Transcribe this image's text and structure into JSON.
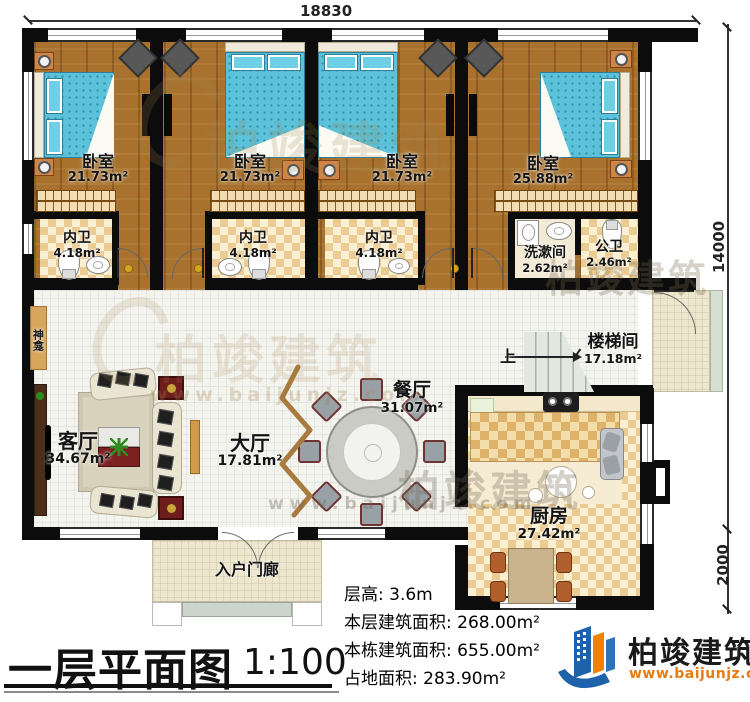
{
  "dimensions": {
    "width_top": "18830",
    "depth_main": "14000",
    "depth_porch": "2000"
  },
  "rooms": {
    "bedroom1": {
      "name": "卧室",
      "area": "21.73m²"
    },
    "bedroom2": {
      "name": "卧室",
      "area": "21.73m²"
    },
    "bedroom3": {
      "name": "卧室",
      "area": "21.73m²"
    },
    "bedroom4": {
      "name": "卧室",
      "area": "25.88m²"
    },
    "ensuite1": {
      "name": "内卫",
      "area": "4.18m²"
    },
    "ensuite2": {
      "name": "内卫",
      "area": "4.18m²"
    },
    "ensuite3": {
      "name": "内卫",
      "area": "4.18m²"
    },
    "washroom": {
      "name": "洗漱间",
      "area": "2.62m²"
    },
    "public_wc": {
      "name": "公卫",
      "area": "2.46m²"
    },
    "stairwell": {
      "name": "楼梯间",
      "area": "17.18m²"
    },
    "dining": {
      "name": "餐厅",
      "area": "31.07m²"
    },
    "hall": {
      "name": "大厅",
      "area": "17.81m²"
    },
    "living": {
      "name": "客厅",
      "area": "34.67m²"
    },
    "kitchen": {
      "name": "厨房",
      "area": "27.42m²"
    },
    "entry_porch": {
      "name": "入户门廊"
    },
    "shrine": {
      "name": "神龛"
    }
  },
  "stairs": {
    "up_label": "上"
  },
  "title": {
    "text": "一层平面图",
    "scale": "1:100"
  },
  "info": {
    "floor_height": {
      "label": "层高:",
      "value": "3.6m"
    },
    "floor_area": {
      "label": "本层建筑面积:",
      "value": "268.00m²"
    },
    "building_area": {
      "label": "本栋建筑面积:",
      "value": "655.00m²"
    },
    "footprint": {
      "label": "占地面积:",
      "value": "283.90m²"
    }
  },
  "logo": {
    "name": "柏竣建筑",
    "website": "www.baijunjz.com"
  },
  "watermark": {
    "brand": "柏竣建筑",
    "website": "www.baijunjz.com"
  },
  "colors": {
    "wall": "#0c0c0c",
    "wood_floor": "#a8722e",
    "bed": "#5cc2da",
    "logo_blue": "#1e62ab",
    "logo_orange": "#ef8200",
    "website_orange": "#e87b12"
  }
}
